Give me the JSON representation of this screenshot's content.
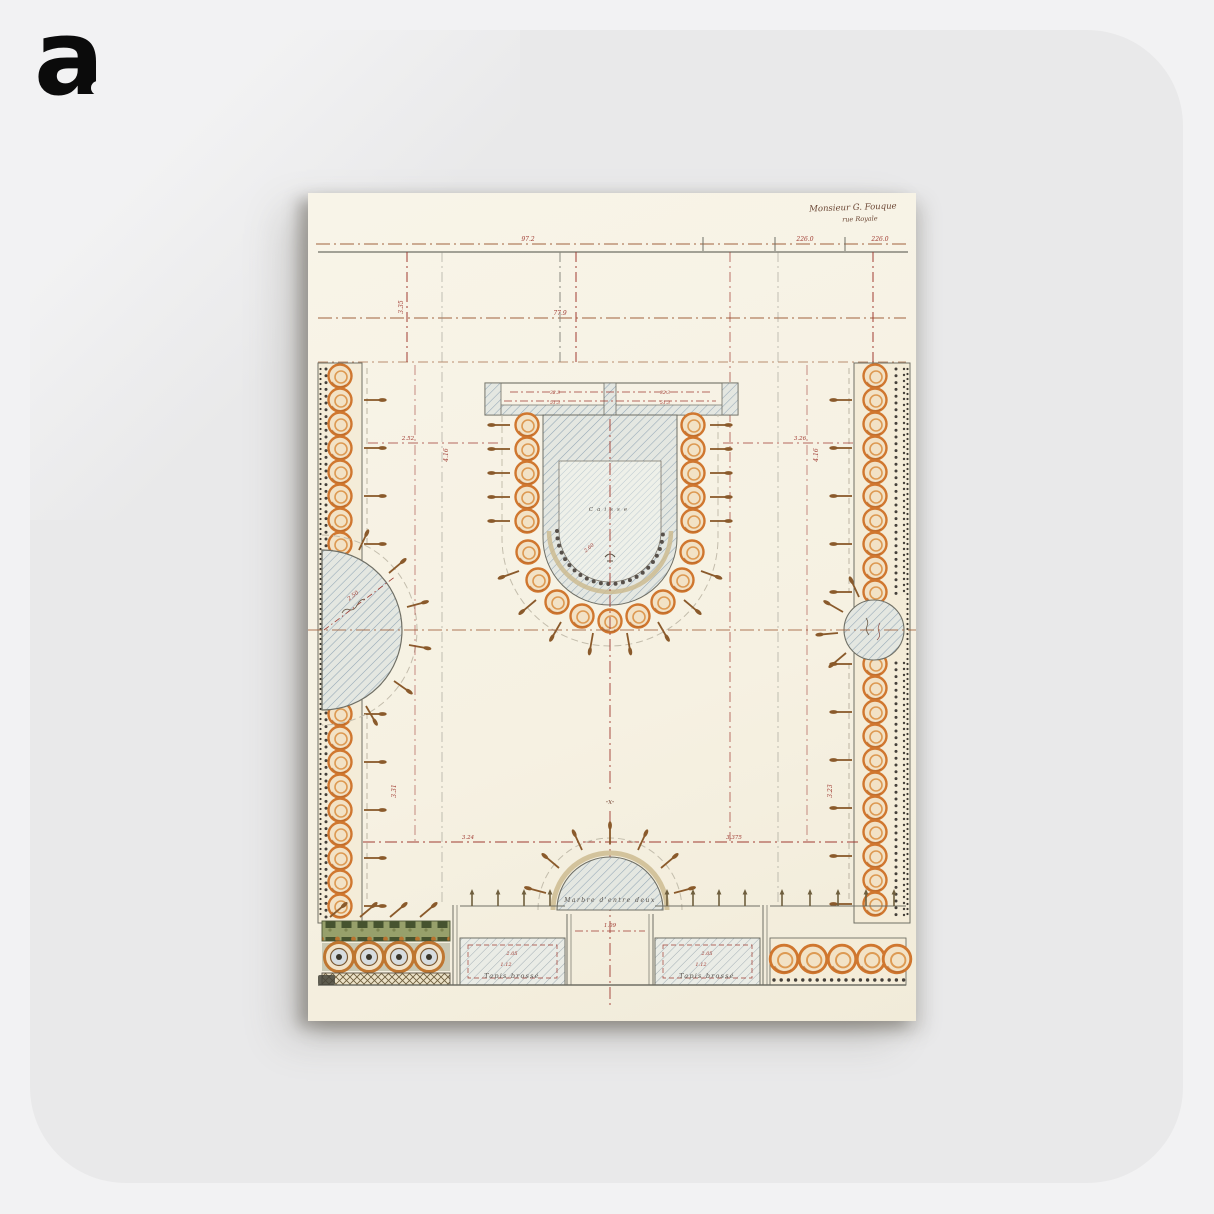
{
  "background": {
    "page_color": "#f2f2f3",
    "panel_color": "#e9e9ea"
  },
  "logo": {
    "letter": "a"
  },
  "poster": {
    "type": "antique garden parterre plan poster",
    "paper_color": "#f8f3e6",
    "colors": {
      "accent_orange": "#d0772f",
      "hatch_blue": "#93a7b6",
      "dim_red": "#a03b32",
      "line_brown": "#a0623d",
      "spike_brown": "#8a5a2b",
      "tan_band": "#cdbb90",
      "foliage_green": "#46532f",
      "ink": "#56504a"
    },
    "signature": {
      "line1": "Monsieur G. Fouque",
      "line2": "rue Royale"
    },
    "labels": {
      "caisse": "Caisse",
      "arch": "Marbre d'entre deux",
      "tapis_left": "Tapis brossé",
      "tapis_right": "Tapis brossé",
      "x_mark": "-x-"
    },
    "dims": {
      "d226a": "226.0",
      "d226b": "226.0",
      "d972": "97.2",
      "d779": "77.9",
      "d335": "3.35",
      "d252": "2.52",
      "d326": "3.26",
      "d323a": "32.3",
      "d323b": "32.3",
      "d513a": "51.3",
      "d513b": "51.3",
      "d416a": "4.16",
      "d416b": "4.16",
      "d331": "3.31",
      "d323r": "3.23",
      "d260": "2.60",
      "d250": "2.50",
      "d324": "3.24",
      "d3375": "3.375",
      "d109": "1.09",
      "d205a": "2.05",
      "d112a": "1.12",
      "d205b": "2.05",
      "d112b": "1.12"
    }
  }
}
